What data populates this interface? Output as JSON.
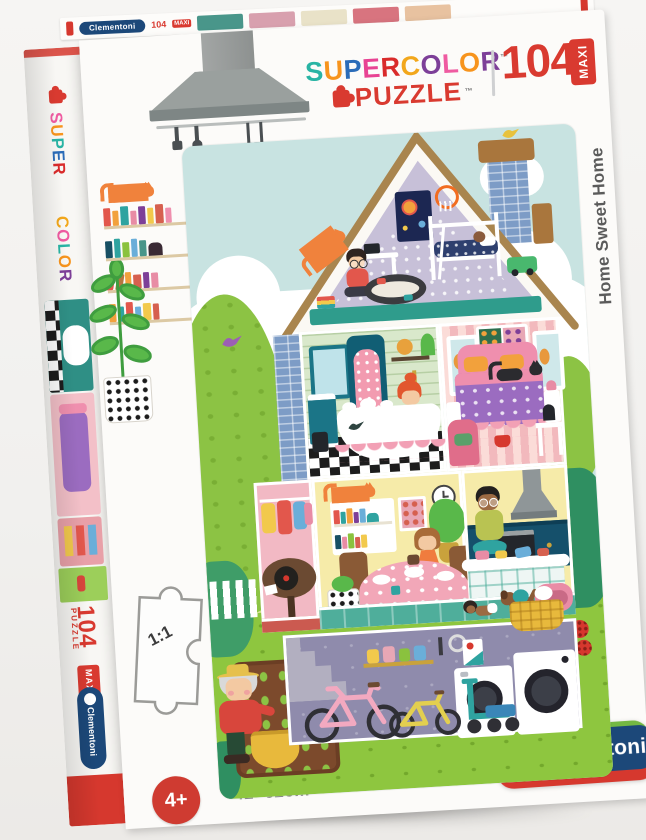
{
  "palette": {
    "brand-blue": "#1c4879",
    "brand-green": "#74b843",
    "brand-red": "#d6382e",
    "logo-red": "#d93a30",
    "badge-red": "#cf3b31",
    "sky": "#c8e3e1",
    "grass": "#8ec63f",
    "title-gray": "#5b5b5b"
  },
  "logo": {
    "line1_letters": [
      {
        "t": "S",
        "c": "#29b4a4"
      },
      {
        "t": "U",
        "c": "#f7941d"
      },
      {
        "t": "P",
        "c": "#2b6cb8"
      },
      {
        "t": "E",
        "c": "#e84393"
      },
      {
        "t": "R",
        "c": "#d92b2b"
      },
      {
        "t": "C",
        "c": "#f2a71b"
      },
      {
        "t": "O",
        "c": "#7d3f98"
      },
      {
        "t": "L",
        "c": "#ef5ba1"
      },
      {
        "t": "O",
        "c": "#f7941d"
      },
      {
        "t": "R",
        "c": "#7d3f98"
      }
    ],
    "tm": "™",
    "line2": "PUZZLE"
  },
  "front": {
    "pieces_count": "104",
    "maxi_label": "MAXI",
    "title_vertical": "Home Sweet Home",
    "scale_label": "1:1",
    "age_label": "4+",
    "size_label": "42×62cm"
  },
  "spine": {
    "word1_letters": [
      {
        "t": "S",
        "c": "#ef5ba1"
      },
      {
        "t": "U",
        "c": "#f7941d"
      },
      {
        "t": "P",
        "c": "#29b4a4"
      },
      {
        "t": "E",
        "c": "#2b6cb8"
      },
      {
        "t": "R",
        "c": "#d92b2b"
      }
    ],
    "word2_letters": [
      {
        "t": "C",
        "c": "#f2a71b"
      },
      {
        "t": "O",
        "c": "#ef5ba1"
      },
      {
        "t": "L",
        "c": "#29b4a4"
      },
      {
        "t": "O",
        "c": "#f7941d"
      },
      {
        "t": "R",
        "c": "#7d3f98"
      }
    ],
    "pieces_count": "104",
    "puzzle_word": "PUZZLE",
    "maxi_label": "MAXI",
    "brand": "Clementoni"
  },
  "top_strip": {
    "brand": "Clementoni",
    "pieces_count": "104",
    "maxi_label": "MAXI"
  },
  "brand": {
    "name": "Clementoni"
  }
}
